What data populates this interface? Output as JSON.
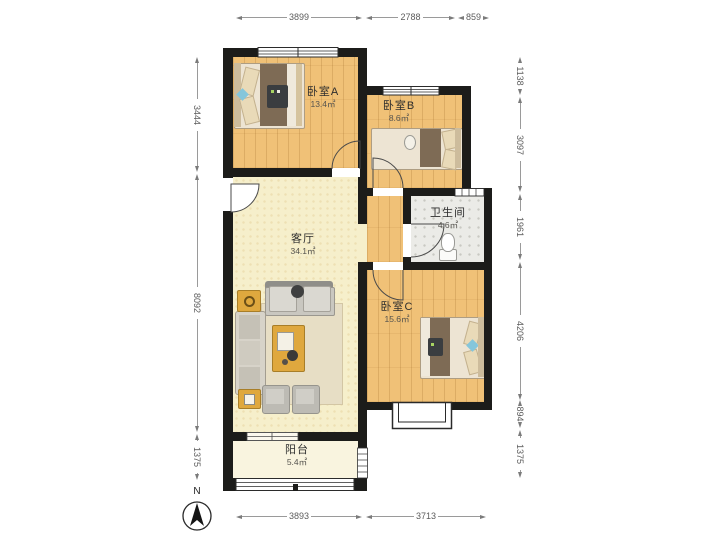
{
  "plan": {
    "type": "apartment-floor-plan",
    "colors": {
      "wall": "#1C1C1A",
      "bedroom_floor": "#F0C177",
      "living_floor": "#F6EFCB",
      "balcony_floor": "#F9F4DF",
      "bathroom_floor": "#EBEBE7",
      "accent_table_gold": "#DFA83E",
      "dimension_line": "#9A9A9A"
    }
  },
  "rooms": {
    "bedroomA": {
      "name": "卧室A",
      "area": "13.4㎡"
    },
    "bedroomB": {
      "name": "卧室B",
      "area": "8.6㎡"
    },
    "bathroom": {
      "name": "卫生间",
      "area": "4.6㎡"
    },
    "living": {
      "name": "客厅",
      "area": "34.1㎡"
    },
    "bedroomC": {
      "name": "卧室C",
      "area": "15.6㎡"
    },
    "balcony": {
      "name": "阳台",
      "area": "5.4㎡"
    }
  },
  "dimensions": {
    "top": [
      "3899",
      "2788",
      "859"
    ],
    "right": [
      "1138",
      "3097",
      "1961",
      "4206",
      "894",
      "1375"
    ],
    "bottom": [
      "3893",
      "3713"
    ],
    "left": [
      "3444",
      "8092",
      "1375"
    ]
  },
  "compass": {
    "label": "N"
  }
}
